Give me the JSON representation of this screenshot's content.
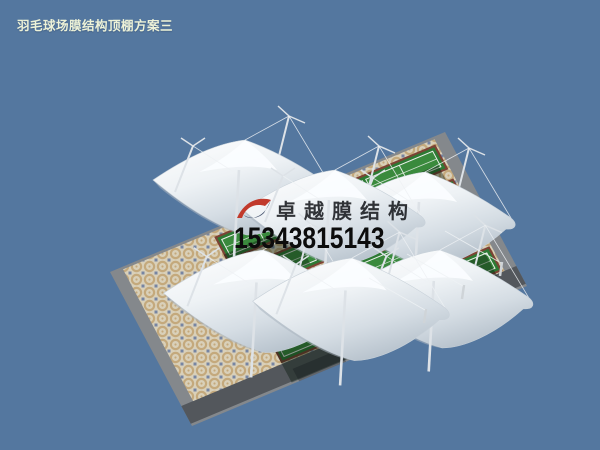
{
  "meta": {
    "width": 600,
    "height": 450,
    "kind": "3d-membrane-structure-render"
  },
  "title": {
    "text": "羽毛球场膜结构顶棚方案三",
    "color": "#edf2d8"
  },
  "watermark": {
    "brand": "卓越膜结构",
    "phone": "15343815143",
    "brand_color": "rgba(28,30,34,0.9)",
    "phone_color": "#0c0c0c",
    "logo_red": "#c13a2c",
    "logo_blue": "#3c4a66"
  },
  "scene": {
    "sky_color": "#54779f",
    "plaza": {
      "affine": [
        335,
        -140,
        82,
        154,
        110,
        272
      ],
      "apron_color": "#84888c",
      "road_color": "#53575c",
      "road_band": [
        0.87,
        0.985
      ],
      "mosaic": {
        "base": "#d9d0b9",
        "ring": "#c4a97c",
        "dot": "#6c7da0",
        "inset": [
          0.035,
          0.015,
          0.965,
          0.87
        ]
      }
    },
    "courts": {
      "band_fill": "#2e7a34",
      "cell_fill": "#3a8a3d",
      "border_color": "#7c4335",
      "line_color": "#e9efe9",
      "a_range": [
        0.3,
        0.96
      ],
      "bands_b": [
        [
          0.045,
          0.205
        ],
        [
          0.265,
          0.425
        ],
        [
          0.485,
          0.645
        ],
        [
          0.705,
          0.865
        ]
      ],
      "cells_a": [
        [
          0.315,
          0.52
        ],
        [
          0.53,
          0.735
        ],
        [
          0.745,
          0.945
        ]
      ]
    },
    "shadows": {
      "court_color": "rgba(9,26,15,0.42)",
      "road_color": "rgba(12,16,20,0.28)",
      "back": {
        "b": [
          0.16,
          0.4
        ],
        "a": [
          [
            0.3,
            0.5
          ],
          [
            0.52,
            0.72
          ],
          [
            0.74,
            0.94
          ]
        ]
      },
      "front": {
        "b": [
          0.74,
          0.99
        ],
        "a": [
          [
            0.3,
            0.5
          ],
          [
            0.52,
            0.72
          ],
          [
            0.74,
            0.94
          ]
        ]
      }
    },
    "canopies": {
      "gradient": [
        "#ffffff",
        "#eef2f5",
        "#d5dde4",
        "#b9c4ce"
      ],
      "edge_color": "#c8d1d9",
      "shade_color": "#a9b5c0",
      "mast_color": "#dde2e7",
      "cable_color": "#eef1f4",
      "items": [
        {
          "name": "canopy-back-left",
          "peak": [
            245,
            140
          ],
          "s": 1.0
        },
        {
          "name": "canopy-back-right",
          "peak": [
            425,
            172
          ],
          "s": 1.0
        },
        {
          "name": "canopy-back-middle",
          "peak": [
            335,
            170
          ],
          "s": 1.0
        },
        {
          "name": "canopy-front-left",
          "peak": [
            263,
            250
          ],
          "s": 1.08
        },
        {
          "name": "canopy-front-right",
          "peak": [
            440,
            250
          ],
          "s": 1.03
        },
        {
          "name": "canopy-front-middle",
          "peak": [
            352,
            258
          ],
          "s": 1.08
        }
      ]
    },
    "anchors": [
      [
        424,
        323
      ],
      [
        462,
        299
      ],
      [
        500,
        276
      ]
    ]
  }
}
